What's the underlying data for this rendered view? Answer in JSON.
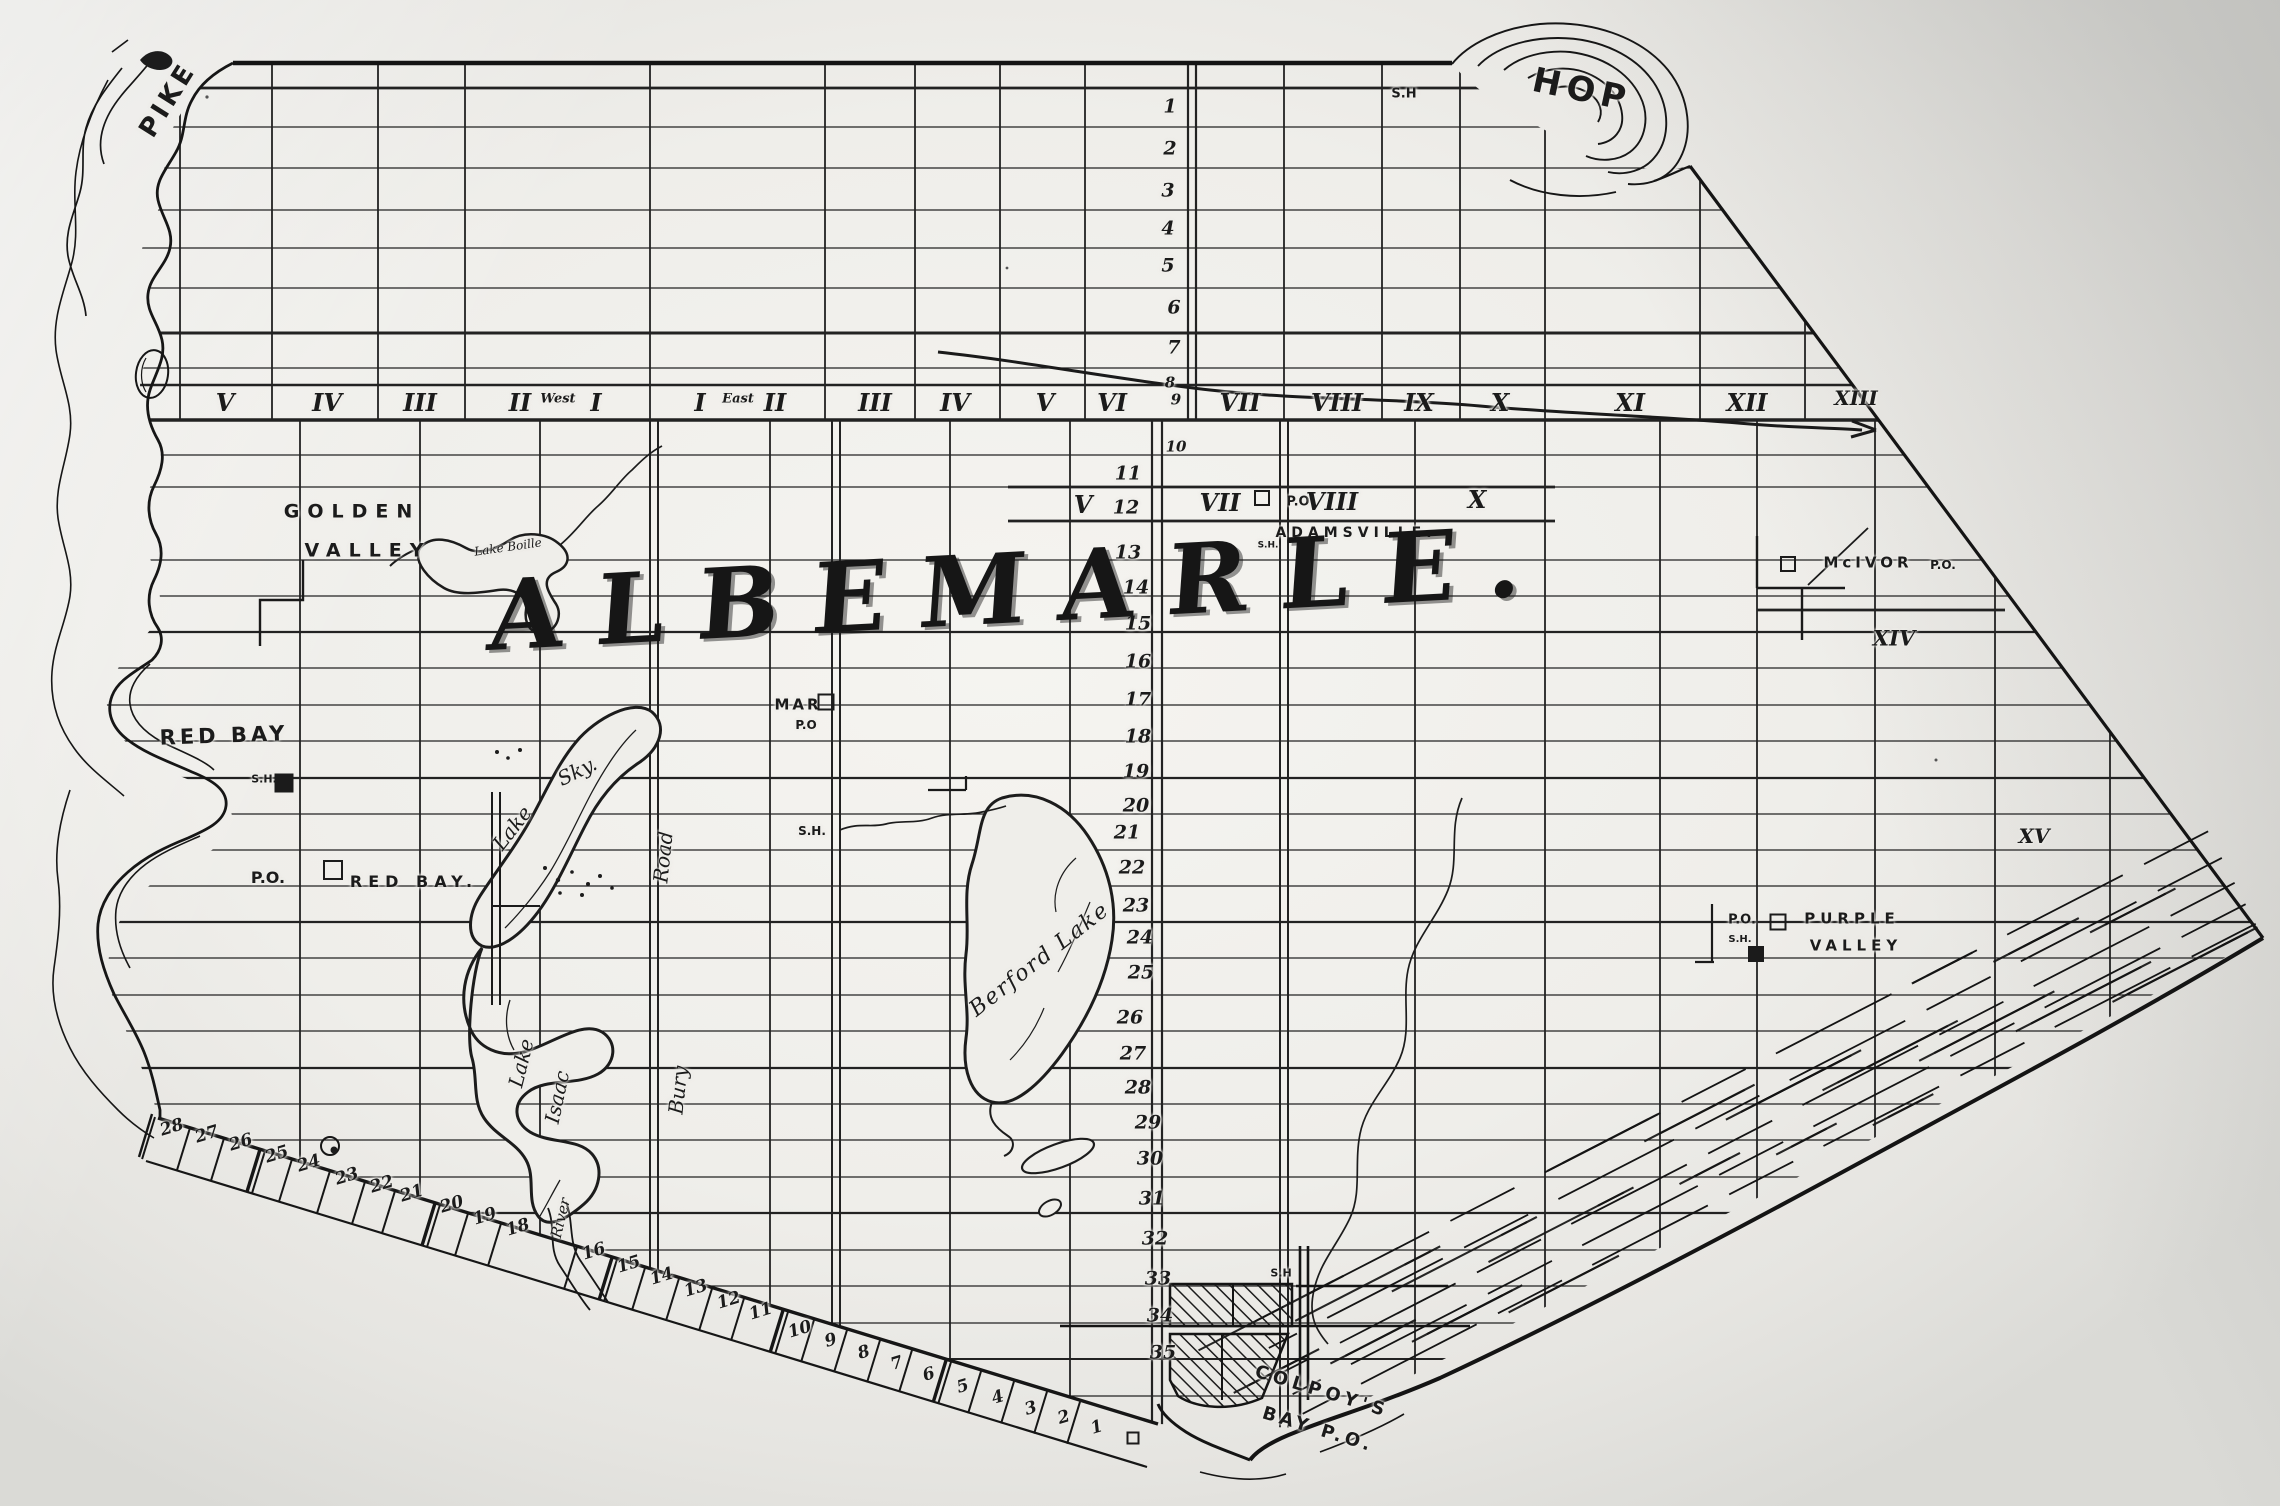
{
  "map_title": "ALBEMARLE.",
  "colors": {
    "ink": "#1c1c1c",
    "paper": "#efeeea"
  },
  "labels": {
    "places": [
      {
        "n": "label-pike-bay",
        "t": "PIKE",
        "x": 168,
        "y": 100,
        "s": 26,
        "r": -58,
        "ls": 4
      },
      {
        "n": "label-hope-bay",
        "t": "HOP",
        "x": 1582,
        "y": 90,
        "s": 34,
        "r": 12,
        "ls": 6
      },
      {
        "n": "label-school-hope",
        "t": "S.H",
        "x": 1404,
        "y": 94,
        "s": 13
      },
      {
        "n": "label-golden-valley-1",
        "t": "GOLDEN",
        "x": 352,
        "y": 512,
        "s": 19,
        "ls": 8
      },
      {
        "n": "label-golden-valley-2",
        "t": "VALLEY",
        "x": 368,
        "y": 551,
        "s": 19,
        "ls": 8
      },
      {
        "n": "label-red-bay",
        "t": "RED BAY",
        "x": 224,
        "y": 736,
        "s": 21,
        "ls": 4,
        "r": -2
      },
      {
        "n": "label-school-red-bay",
        "t": "S.H.",
        "x": 264,
        "y": 779,
        "s": 11
      },
      {
        "n": "label-red-bay-po",
        "t": "P.O.",
        "x": 268,
        "y": 878,
        "s": 16
      },
      {
        "n": "label-red-bay-po-name",
        "t": "RED BAY.",
        "x": 414,
        "y": 882,
        "s": 16,
        "ls": 6
      },
      {
        "n": "label-mar",
        "t": "MAR",
        "x": 798,
        "y": 705,
        "s": 15,
        "ls": 3
      },
      {
        "n": "label-mar-po",
        "t": "P.O",
        "x": 806,
        "y": 725,
        "s": 12
      },
      {
        "n": "label-school-mar",
        "t": "S.H.",
        "x": 812,
        "y": 831,
        "s": 12
      },
      {
        "n": "label-adamsville",
        "t": "ADAMSVILLE.",
        "x": 1356,
        "y": 533,
        "s": 14,
        "ls": 5
      },
      {
        "n": "label-adamsville-po",
        "t": "P.O",
        "x": 1298,
        "y": 502,
        "s": 13
      },
      {
        "n": "label-school-adamsville",
        "t": "S.H.",
        "x": 1268,
        "y": 546,
        "s": 9
      },
      {
        "n": "label-purple-valley-po",
        "t": "P.O.",
        "x": 1742,
        "y": 920,
        "s": 13
      },
      {
        "n": "label-school-purple-valley",
        "t": "S.H.",
        "x": 1740,
        "y": 940,
        "s": 10
      },
      {
        "n": "label-purple-valley-1",
        "t": "PURPLE",
        "x": 1852,
        "y": 919,
        "s": 15,
        "ls": 5
      },
      {
        "n": "label-purple-valley-2",
        "t": "VALLEY",
        "x": 1856,
        "y": 946,
        "s": 15,
        "ls": 5
      },
      {
        "n": "label-mcivor",
        "t": "McIVOR",
        "x": 1868,
        "y": 563,
        "s": 15,
        "ls": 4
      },
      {
        "n": "label-mcivor-po",
        "t": "P.O.",
        "x": 1943,
        "y": 565,
        "s": 12
      },
      {
        "n": "label-colpoys-1",
        "t": "COLPOY'S",
        "x": 1322,
        "y": 1392,
        "s": 18,
        "ls": 5,
        "r": 17
      },
      {
        "n": "label-colpoys-2",
        "t": "BAY P.O.",
        "x": 1318,
        "y": 1430,
        "s": 18,
        "ls": 4,
        "r": 17
      },
      {
        "n": "label-school-colpoys",
        "t": "S.H",
        "x": 1281,
        "y": 1273,
        "s": 11
      }
    ],
    "concessions_row1": [
      {
        "t": "V",
        "x": 225
      },
      {
        "t": "IV",
        "x": 327
      },
      {
        "t": "III",
        "x": 420
      },
      {
        "t": "II",
        "x": 520
      },
      {
        "t": "West",
        "x": 558,
        "s": 13,
        "y": 399
      },
      {
        "t": "I",
        "x": 596
      },
      {
        "t": "I",
        "x": 700
      },
      {
        "t": "East",
        "x": 738,
        "s": 13,
        "y": 399
      },
      {
        "t": "II",
        "x": 775
      },
      {
        "t": "III",
        "x": 875
      },
      {
        "t": "IV",
        "x": 955
      },
      {
        "t": "V",
        "x": 1045
      },
      {
        "t": "VI",
        "x": 1112
      },
      {
        "t": "VII",
        "x": 1240
      },
      {
        "t": "VIII",
        "x": 1337
      },
      {
        "t": "IX",
        "x": 1419
      },
      {
        "t": "X",
        "x": 1500
      },
      {
        "t": "XI",
        "x": 1630
      },
      {
        "t": "XII",
        "x": 1747
      },
      {
        "t": "XIII",
        "x": 1856,
        "s": 20,
        "y": 398
      }
    ],
    "concessions_row2": [
      {
        "t": "V",
        "x": 1083,
        "y": 505
      },
      {
        "t": "VII",
        "x": 1220,
        "y": 503
      },
      {
        "t": "VIII",
        "x": 1332,
        "y": 502
      },
      {
        "t": "X",
        "x": 1477,
        "y": 500
      },
      {
        "t": "XIV",
        "x": 1894,
        "y": 638,
        "s": 21
      },
      {
        "t": "XV",
        "x": 2034,
        "y": 836,
        "s": 20
      }
    ],
    "lots_center": [
      {
        "t": "1",
        "x": 1170,
        "y": 107
      },
      {
        "t": "2",
        "x": 1170,
        "y": 149
      },
      {
        "t": "3",
        "x": 1168,
        "y": 191
      },
      {
        "t": "4",
        "x": 1168,
        "y": 229
      },
      {
        "t": "5",
        "x": 1168,
        "y": 266
      },
      {
        "t": "6",
        "x": 1174,
        "y": 308
      },
      {
        "t": "7",
        "x": 1174,
        "y": 348
      },
      {
        "t": "8",
        "x": 1170,
        "y": 383,
        "s": 15
      },
      {
        "t": "9",
        "x": 1176,
        "y": 400,
        "s": 15
      },
      {
        "t": "10",
        "x": 1176,
        "y": 447,
        "s": 15
      },
      {
        "t": "11",
        "x": 1128,
        "y": 474
      },
      {
        "t": "12",
        "x": 1126,
        "y": 508
      },
      {
        "t": "13",
        "x": 1128,
        "y": 553
      },
      {
        "t": "14",
        "x": 1136,
        "y": 588
      },
      {
        "t": "15",
        "x": 1138,
        "y": 624
      },
      {
        "t": "16",
        "x": 1138,
        "y": 662
      },
      {
        "t": "17",
        "x": 1138,
        "y": 700
      },
      {
        "t": "18",
        "x": 1138,
        "y": 737
      },
      {
        "t": "19",
        "x": 1136,
        "y": 772
      },
      {
        "t": "20",
        "x": 1136,
        "y": 806
      },
      {
        "t": "21",
        "x": 1127,
        "y": 833
      },
      {
        "t": "22",
        "x": 1132,
        "y": 868
      },
      {
        "t": "23",
        "x": 1136,
        "y": 906
      },
      {
        "t": "24",
        "x": 1140,
        "y": 938
      },
      {
        "t": "25",
        "x": 1141,
        "y": 973
      },
      {
        "t": "26",
        "x": 1130,
        "y": 1018
      },
      {
        "t": "27",
        "x": 1133,
        "y": 1054
      },
      {
        "t": "28",
        "x": 1138,
        "y": 1088
      },
      {
        "t": "29",
        "x": 1148,
        "y": 1123
      },
      {
        "t": "30",
        "x": 1150,
        "y": 1159
      },
      {
        "t": "31",
        "x": 1152,
        "y": 1199
      },
      {
        "t": "32",
        "x": 1155,
        "y": 1239
      },
      {
        "t": "33",
        "x": 1158,
        "y": 1279
      },
      {
        "t": "34",
        "x": 1160,
        "y": 1316
      },
      {
        "t": "35",
        "x": 1163,
        "y": 1353
      }
    ],
    "lots_shore": [
      {
        "t": "28",
        "x": 172,
        "y": 1128
      },
      {
        "t": "27",
        "x": 207,
        "y": 1135
      },
      {
        "t": "26",
        "x": 241,
        "y": 1143
      },
      {
        "t": "25",
        "x": 277,
        "y": 1155,
        "h": 1
      },
      {
        "t": "24",
        "x": 309,
        "y": 1164
      },
      {
        "t": "23",
        "x": 347,
        "y": 1177
      },
      {
        "t": "22",
        "x": 382,
        "y": 1185
      },
      {
        "t": "21",
        "x": 412,
        "y": 1194
      },
      {
        "t": "20",
        "x": 452,
        "y": 1205,
        "h": 1
      },
      {
        "t": "19",
        "x": 485,
        "y": 1217
      },
      {
        "t": "18",
        "x": 518,
        "y": 1228
      },
      {
        "t": "16",
        "x": 594,
        "y": 1252
      },
      {
        "t": "15",
        "x": 629,
        "y": 1265,
        "h": 1
      },
      {
        "t": "14",
        "x": 662,
        "y": 1277
      },
      {
        "t": "13",
        "x": 696,
        "y": 1289
      },
      {
        "t": "12",
        "x": 729,
        "y": 1301
      },
      {
        "t": "11",
        "x": 761,
        "y": 1312
      },
      {
        "t": "10",
        "x": 800,
        "y": 1330,
        "h": 1
      },
      {
        "t": "9",
        "x": 831,
        "y": 1341
      },
      {
        "t": "8",
        "x": 864,
        "y": 1353
      },
      {
        "t": "7",
        "x": 897,
        "y": 1364
      },
      {
        "t": "6",
        "x": 929,
        "y": 1375
      },
      {
        "t": "5",
        "x": 963,
        "y": 1387,
        "h": 1
      },
      {
        "t": "4",
        "x": 998,
        "y": 1398
      },
      {
        "t": "3",
        "x": 1031,
        "y": 1409
      },
      {
        "t": "2",
        "x": 1064,
        "y": 1418
      },
      {
        "t": "1",
        "x": 1097,
        "y": 1428
      }
    ],
    "waters": [
      {
        "n": "label-sky-lake-1",
        "t": "Lake",
        "x": 512,
        "y": 828,
        "s": 20,
        "r": -52
      },
      {
        "n": "label-sky-lake-2",
        "t": "Sky.",
        "x": 577,
        "y": 771,
        "s": 20,
        "r": -26
      },
      {
        "n": "label-isaac-lake-1",
        "t": "Lake",
        "x": 521,
        "y": 1063,
        "s": 20,
        "r": -76
      },
      {
        "n": "label-isaac-lake-2",
        "t": "Isaac",
        "x": 557,
        "y": 1097,
        "s": 20,
        "r": -78
      },
      {
        "n": "label-berford-lake",
        "t": "Berford Lake",
        "x": 1040,
        "y": 960,
        "s": 22,
        "r": -38,
        "ls": 2
      },
      {
        "n": "label-small-lake",
        "t": "Lake Boille",
        "x": 508,
        "y": 547,
        "s": 12,
        "r": -8
      },
      {
        "n": "label-river",
        "t": "River",
        "x": 561,
        "y": 1218,
        "s": 15,
        "r": -76
      }
    ],
    "roads": [
      {
        "n": "label-bury-road-1",
        "t": "Bury",
        "x": 678,
        "y": 1090,
        "s": 20,
        "r": -84
      },
      {
        "n": "label-bury-road-2",
        "t": "Road",
        "x": 663,
        "y": 857,
        "s": 20,
        "r": -84
      }
    ]
  },
  "markers": [
    {
      "n": "school-marker",
      "x": 284,
      "y": 783,
      "s": 15,
      "fill": true
    },
    {
      "n": "po-marker",
      "x": 333,
      "y": 870,
      "s": 16
    },
    {
      "n": "po-marker",
      "x": 826,
      "y": 702,
      "s": 13
    },
    {
      "n": "po-marker",
      "x": 1262,
      "y": 498,
      "s": 12
    },
    {
      "n": "po-marker",
      "x": 1788,
      "y": 564,
      "s": 12
    },
    {
      "n": "po-marker",
      "x": 1778,
      "y": 922,
      "s": 13
    },
    {
      "n": "school-marker",
      "x": 1756,
      "y": 954,
      "s": 12,
      "fill": true
    },
    {
      "n": "po-marker",
      "x": 1133,
      "y": 1438,
      "s": 9
    }
  ]
}
